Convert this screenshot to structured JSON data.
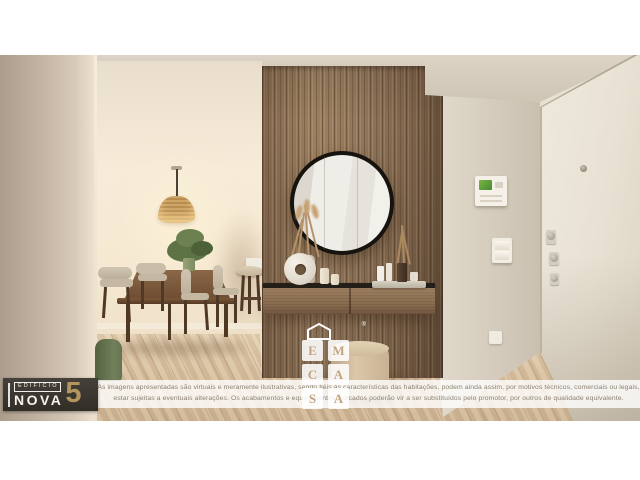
{
  "branding": {
    "logo_building": "EDIFICIO",
    "logo_name": "NOVA",
    "logo_number": "5",
    "watermark_name": "EM CASA",
    "watermark_letters": [
      "E",
      "M",
      "C",
      "A",
      "S",
      "A"
    ],
    "watermark_registered": "®"
  },
  "disclaimer": {
    "line1": "As imagens apresentadas são virtuais e meramente ilustrativas, sendo fiéis às características das habitações, podem ainda assim, por motivos técnicos, comerciais ou legais,",
    "line2": "estar sujeitas a eventuais alterações. Os acabamentos e equipamentos indicados poderão vir a ser substituídos pelo promotor, por outros de qualidade equivalente."
  },
  "colors": {
    "logo_background": "#3b3833",
    "logo_gold": "#b3955e",
    "wood_panel": "#96785a",
    "floor_wood": "#d6c0a1",
    "wall_cream": "#f3e8d6",
    "mirror_frame": "#17130f",
    "intercom_screen_green": "#5ea338",
    "disclaimer_text": "#8a8172"
  }
}
